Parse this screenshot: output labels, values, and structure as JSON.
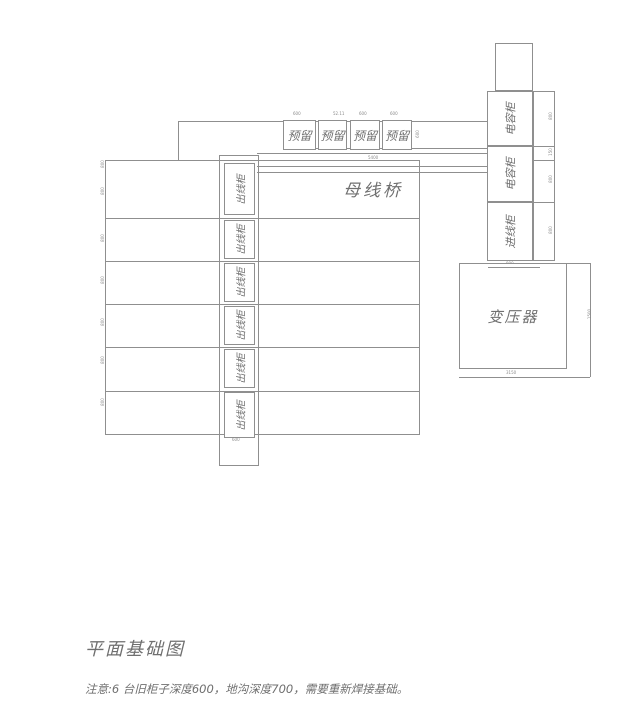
{
  "title": "平面基础图",
  "note": "注意:6 台旧柜子深度600，地沟深度700，需要重新焊接基础。",
  "labels": {
    "busbar_bridge": "母线桥",
    "transformer": "变压器"
  },
  "cabinets": {
    "outgoing": [
      "出线柜",
      "出线柜",
      "出线柜",
      "出线柜",
      "出线柜",
      "出线柜"
    ],
    "reserved": [
      "预留",
      "预留",
      "预留",
      "预留"
    ],
    "capacitor": [
      "电容柜",
      "电容柜"
    ],
    "incoming": "进线柜"
  },
  "dims": {
    "reserved_top": [
      "600",
      "52.11",
      "600",
      "600"
    ],
    "reserved_right": "600",
    "busbar_len": "5400",
    "outgoing_bottom": "600",
    "right_cells": [
      "800",
      "150",
      "800",
      "800"
    ],
    "left_ticks": [
      "800",
      "800",
      "800",
      "800",
      "800",
      "800",
      "800"
    ],
    "transformer_bottom": "3150",
    "transformer_right": "1500",
    "transformer_top": "900"
  },
  "colors": {
    "line": "#8f8f8f",
    "text": "#6f6f6f",
    "dim": "#8a8a8a",
    "background": "#ffffff"
  }
}
